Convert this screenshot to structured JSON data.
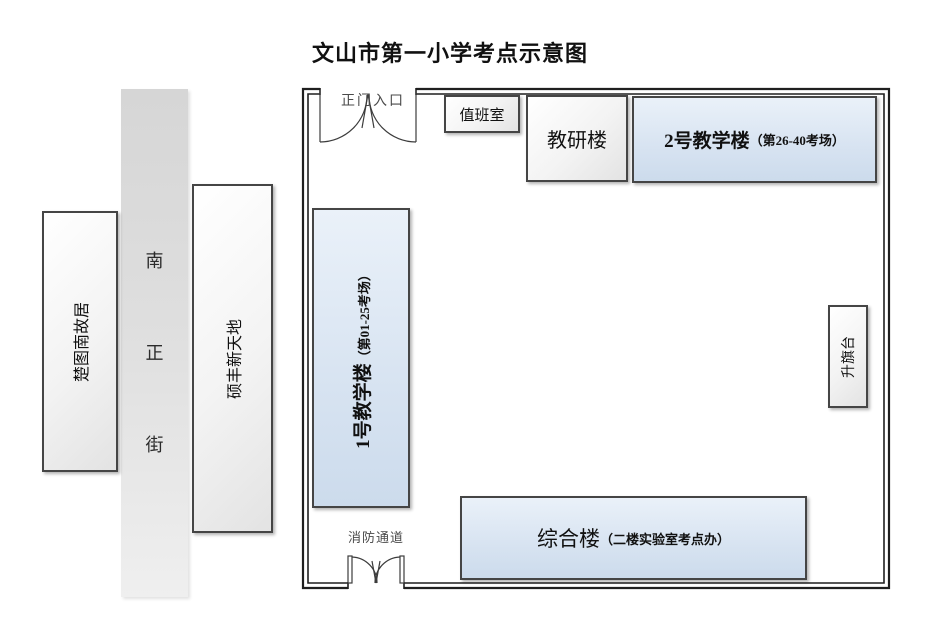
{
  "title": "文山市第一小学考点示意图",
  "street": {
    "name": "南正街",
    "char_1": "南",
    "char_2": "正",
    "char_3": "街"
  },
  "west": {
    "residence": "楚图南故居",
    "plaza": "硕丰新天地"
  },
  "campus": {
    "main_gate_label": "正门入口",
    "fire_exit_label": "消防通道",
    "duty_room": "值班室",
    "research_building": "教研楼",
    "teaching_building_2": "2号教学楼",
    "teaching_building_2_sub": "（第26-40考场）",
    "teaching_building_1": "1号教学楼",
    "teaching_building_1_sub": "（第01-25考场）",
    "flag_platform": "升旗台",
    "complex_building": "综合楼",
    "complex_building_sub": "（二楼实验室考点办）"
  },
  "colors": {
    "building_blue": "#d7e3f1",
    "box_gray": "#e7e7e7",
    "street_gray": "#d9d9d9",
    "wall_line": "#1f1f1f"
  }
}
